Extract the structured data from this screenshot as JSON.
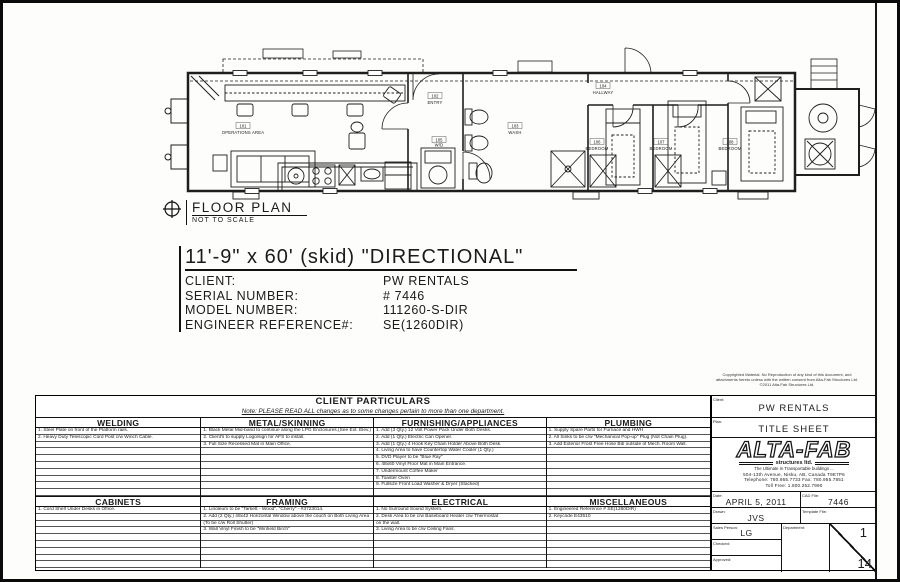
{
  "plan": {
    "caption": "FLOOR PLAN",
    "scale_note": "NOT TO SCALE",
    "rooms": [
      {
        "num": "101",
        "name": "OPERATIONS AREA"
      },
      {
        "num": "102",
        "name": "ENTRY"
      },
      {
        "num": "103",
        "name": "WASH"
      },
      {
        "num": "104",
        "name": "HALLWAY"
      },
      {
        "num": "105",
        "name": "W/D"
      },
      {
        "num": "106",
        "name": "BEDROOM"
      },
      {
        "num": "107",
        "name": "BEDROOM"
      },
      {
        "num": "108",
        "name": "BEDROOM"
      }
    ]
  },
  "title_section": {
    "title": "11'-9\" x 60' (skid) \"DIRECTIONAL\"",
    "fields": [
      {
        "label": "CLIENT:",
        "value": "PW RENTALS"
      },
      {
        "label": "SERIAL NUMBER:",
        "value": "# 7446"
      },
      {
        "label": "MODEL NUMBER:",
        "value": "111260-S-DIR"
      },
      {
        "label": "ENGINEER REFERENCE#:",
        "value": "SE(1260DIR)"
      }
    ]
  },
  "particulars": {
    "title": "CLIENT PARTICULARS",
    "note": "Note: PLEASE READ ALL changes as to some changes pertain to more than one department.",
    "top": [
      {
        "header": "WELDING",
        "rows": [
          "1. Steel Plate on front of the Platform rails.",
          "2. Heavy Duty Telescopic Cord Post c/w Winch Cable."
        ]
      },
      {
        "header": "METAL/SKINNING",
        "rows": [
          "1. Black Metal Mid-band to continue along the LPG Enclosures.(See Ext. Elev.)",
          "2. Client's to supply Logo/sign for AFS to install.",
          "3. Full Size Recessed Mat in Main Office."
        ]
      },
      {
        "header": "FURNISHING/APPLIANCES",
        "rows": [
          "1. Add (3 Qty.) 12 Volt Power Pack Under Both Desks.",
          "2. Add (1 Qty.) Electric Can Opener.",
          "3. Add (1 Qty.) 4 Hook Key Chain Holder Above Both Desk.",
          "4. Living Area to have Countertop Water Cooler (1 Qty.)",
          "5. DVD Player to be \"Blue Ray\"",
          "6. 48x60 Vinyl Floor Mat in Main Entrance.",
          "7. Undermount Coffee Maker",
          "8. Toaster Oven",
          "9. Fullsize Front Load Washer & Dryer (Stacked)"
        ]
      },
      {
        "header": "PLUMBING",
        "rows": [
          "1. Supply Spare Parts for Furnace and HWH",
          "2. All Sinks to be c/w \"Mechanical Pop-up\" Plug (Not Chain Plug).",
          "3. Add Exterior Frost Free Hose Bib outside of Mech. Room Wall."
        ]
      }
    ],
    "bottom": [
      {
        "header": "CABINETS",
        "rows": [
          "1. Cord Shelf Under Desks in Office."
        ]
      },
      {
        "header": "FRAMING",
        "rows": [
          "1. Linoleum to be \"Tarkett - Wood\", \"Cherry\" - #3723014.",
          "2. Add (2 Qty.) 48x42 Horizontal Window above the couch on Both Living Area",
          "    (To be c/w Roll Shutter)",
          "3. Wall Vinyl Finish to be \"Winfield Birch\""
        ]
      },
      {
        "header": "ELECTRICAL",
        "rows": [
          "1. No Surround Sound System.",
          "2. Desk Area to be c/w Baseboard Heater c/w Thermostat",
          "    on the wall.",
          "3. Living Area to be c/w Ceiling Fans."
        ]
      },
      {
        "header": "MISCELLANEOUS",
        "rows": [
          "1. Engineered Reference # SE(1260DIR)",
          "2. Keycode E43510"
        ]
      }
    ]
  },
  "title_block": {
    "client_label": "Client:",
    "client": "PW RENTALS",
    "plan_label": "Plan:",
    "plan": "TITLE SHEET",
    "logo": "ALTA-FAB",
    "logo_sub": "structures ltd.",
    "logo_tag": "The Ultimate In Transportable buildings ...",
    "address": "504-13th Avenue, Nisku, AB, Canada T9E7P6",
    "phone": "Telephone: 780.955.7733   Fax: 780.955.7851",
    "tollfree": "Toll Free: 1.800.252.7990",
    "date_label": "Date:",
    "date": "APRIL 5, 2011",
    "cad_label": "CAD File:",
    "cad": "7446",
    "drawn_label": "Drawn:",
    "drawn": "JVS",
    "template_label": "Template File:",
    "template": "",
    "sales_label": "Sales Person:",
    "sales": "LG",
    "dept_label": "Department:",
    "dept": "",
    "checked_label": "Checked:",
    "checked": "",
    "approved_label": "Approved:",
    "approved": "",
    "sheet_num": "1",
    "sheet_total": "14"
  },
  "copyright": {
    "line1": "Copyrighted Material. No Reproduction of any kind of this document, and",
    "line2": "attachments hereto unless with the written consent from Alta-Fab Structures Ltd.",
    "line3": "©2011 Alta-Fab Structures Ltd."
  }
}
